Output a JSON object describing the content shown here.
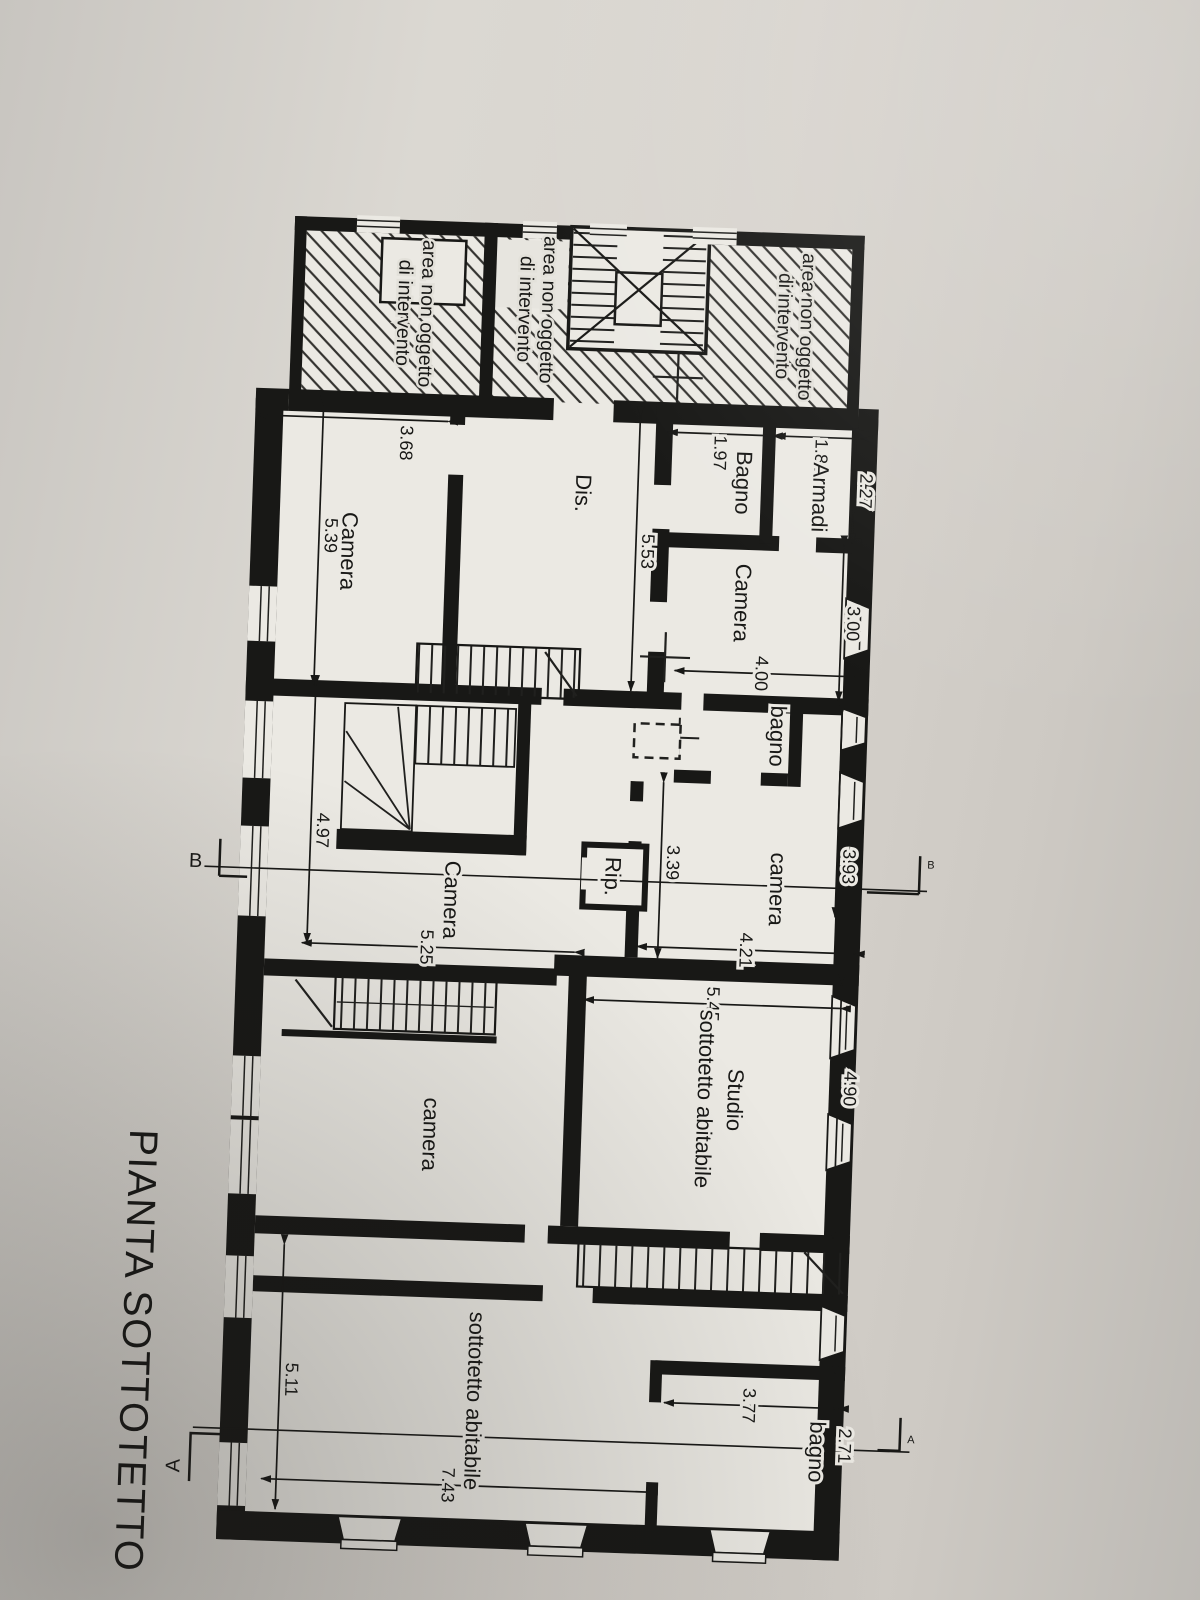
{
  "title": "PIANTA SOTTOTETTO",
  "area_note": {
    "line1": "area non oggetto",
    "line2": "di intervento"
  },
  "rooms": {
    "camera_nw": "Camera",
    "bagno_nw": "Bagno",
    "armadi": "Armadi",
    "dis": "Dis.",
    "camera_w": "Camera",
    "bagno_mid": "bagno",
    "camera_mid": "camera",
    "rip": "Rip.",
    "camera_sw": "Camera",
    "camera_c": "camera",
    "studio_line1": "Studio",
    "studio_line2": "sottotetto abitabile",
    "sottotetto": "sottotetto abitabile",
    "bagno_se": "bagno"
  },
  "dims": {
    "d227": "2.27",
    "d188": "1.88",
    "d197": "1.97",
    "d300": "3.00",
    "d400": "4.00",
    "d553": "5.53",
    "d368": "3.68",
    "d539": "5.39",
    "d393": "3.93",
    "d421": "4.21",
    "d339": "3.39",
    "d497": "4.97",
    "d525": "5.25",
    "d545": "5.45",
    "d490": "4.90",
    "d271": "2.71",
    "d377": "3.77",
    "d511": "5.11",
    "d743": "7.43"
  },
  "sections": {
    "a": "A",
    "b": "B"
  },
  "colors": {
    "ink": "#181816",
    "paper": "#ebe9e3",
    "sheet": "#d5d2cc",
    "hatch": "#32312e"
  }
}
